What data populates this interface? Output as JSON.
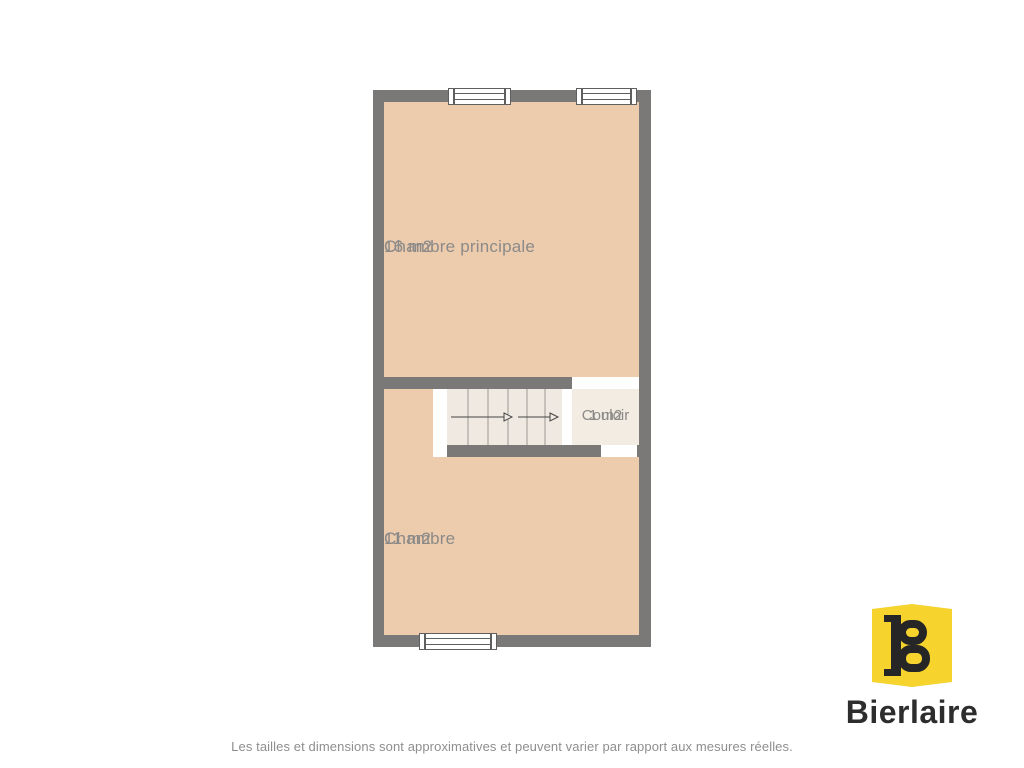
{
  "theme": {
    "wall": "#7b7977",
    "room-fill": "#edcbad",
    "stair-fill": "#f0e9e1",
    "corridor-fill": "#f2ece2",
    "label": "#8b8a88",
    "tread-line": "#9b9894",
    "arrow": "#454545",
    "window-line": "#5f5f5f",
    "logo-yellow": "#f6d32d",
    "logo-ink": "#262626",
    "brand-text": "#2d2d2d",
    "disclaimer-text": "#8e8e8e"
  },
  "plan": {
    "rooms": {
      "master": {
        "name": "Chambre principale",
        "area": "16 m2"
      },
      "bedroom": {
        "name": "Chambre",
        "area": "11 m2"
      },
      "corridor": {
        "name": "Couloir",
        "area": "1 m2"
      }
    }
  },
  "branding": {
    "name": "Bierlaire",
    "monogram": "B"
  },
  "footer": {
    "disclaimer": "Les tailles et dimensions sont approximatives et peuvent varier par rapport aux mesures réelles."
  }
}
